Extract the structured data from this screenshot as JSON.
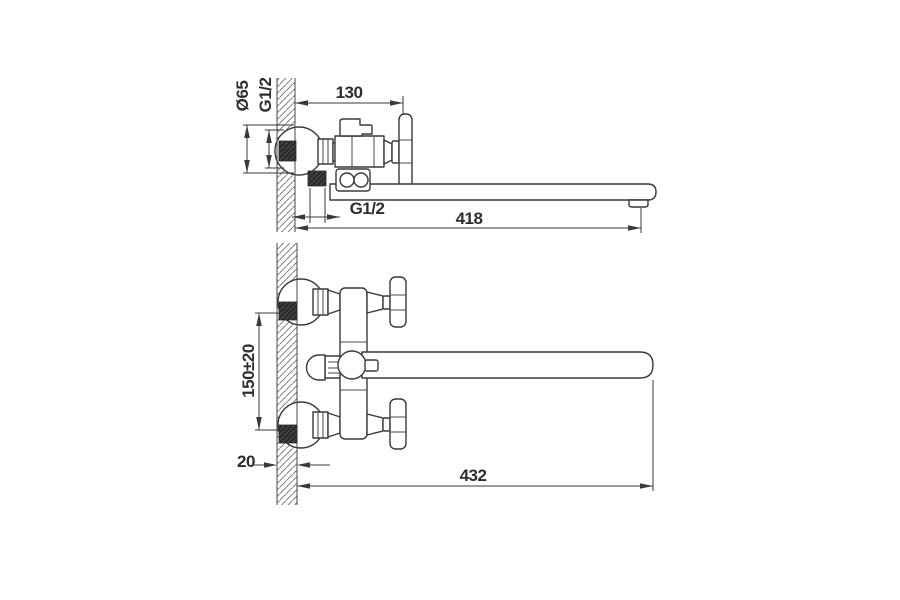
{
  "views": {
    "side": {
      "flange_diameter": "Ø65",
      "wall_thread": "G1/2",
      "depth": "130",
      "shower_thread": "G1/2",
      "spout_reach": "418"
    },
    "plan": {
      "inlet_centers": "150±20",
      "wall_thickness": "20",
      "spout_reach": "432"
    }
  },
  "colors": {
    "line": "#3a3a3a",
    "text": "#2e2e2e",
    "dark_fill": "#2b2b2b",
    "background": "#ffffff"
  }
}
